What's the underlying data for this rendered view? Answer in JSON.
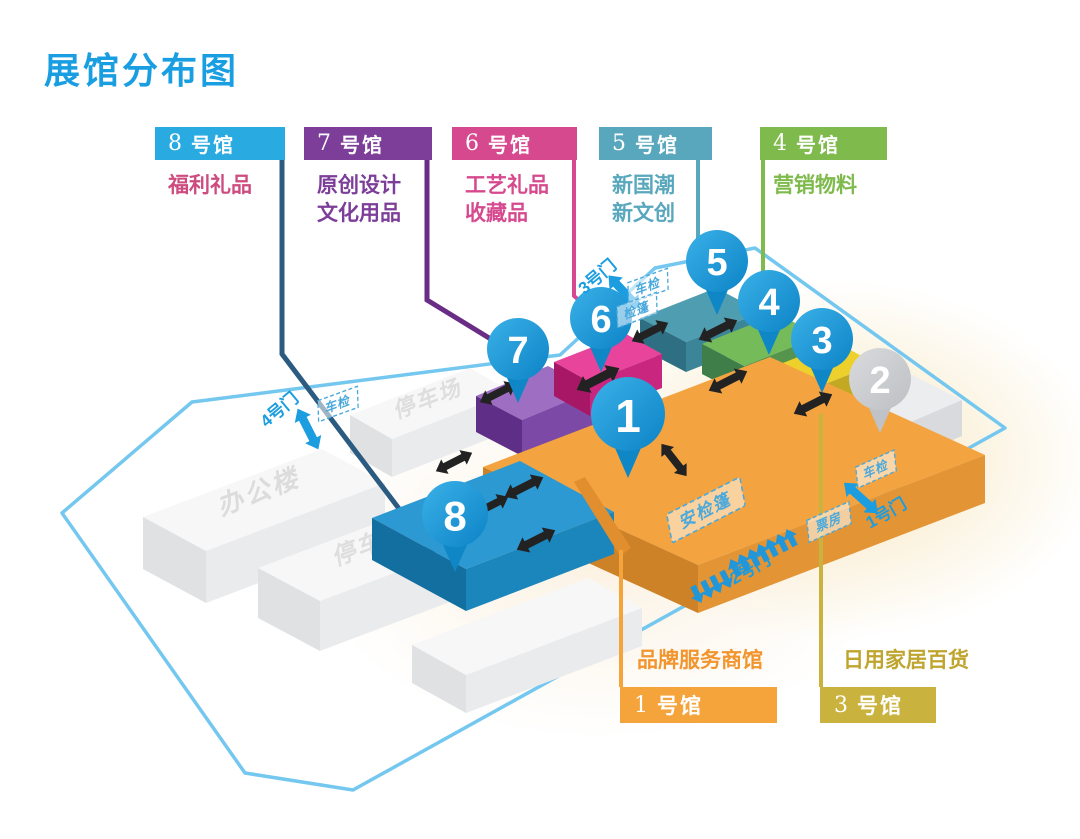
{
  "title": "展馆分布图",
  "top_halls": [
    {
      "num": "8",
      "suffix": "号馆",
      "desc_lines": [
        "福利礼品"
      ],
      "header_bg": "#29ABE2",
      "desc_color": "#CE4B80"
    },
    {
      "num": "7",
      "suffix": "号馆",
      "desc_lines": [
        "原创设计",
        "文化用品"
      ],
      "header_bg": "#7C3E98",
      "desc_color": "#7C3E98"
    },
    {
      "num": "6",
      "suffix": "号馆",
      "desc_lines": [
        "工艺礼品",
        "收藏品"
      ],
      "header_bg": "#D6498F",
      "desc_color": "#D6498F"
    },
    {
      "num": "5",
      "suffix": "号馆",
      "desc_lines": [
        "新国潮",
        "新文创"
      ],
      "header_bg": "#58A7BC",
      "desc_color": "#58A7BC"
    },
    {
      "num": "4",
      "suffix": "号馆",
      "desc_lines": [
        "营销物料"
      ],
      "header_bg": "#7FBA4C",
      "desc_color": "#7FBA4C"
    }
  ],
  "bottom_halls": [
    {
      "num": "1",
      "suffix": "号馆",
      "desc": "品牌服务商馆",
      "header_bg": "#F5A33B",
      "desc_color": "#F2952E"
    },
    {
      "num": "3",
      "suffix": "号馆",
      "desc": "日用家居百货",
      "header_bg": "#C9B23D",
      "desc_color": "#BFA52E"
    }
  ],
  "pins": [
    {
      "n": "1"
    },
    {
      "n": "2"
    },
    {
      "n": "3"
    },
    {
      "n": "4"
    },
    {
      "n": "5"
    },
    {
      "n": "6"
    },
    {
      "n": "7"
    },
    {
      "n": "8"
    }
  ],
  "buildings": {
    "office": "办公楼",
    "parking_top": "停车场",
    "parking_mid": "停车场"
  },
  "gates": {
    "g1": "1号门",
    "g2": "2号门",
    "g3": "3号门",
    "g4": "4号门"
  },
  "checkpoints": {
    "vehicle": "车检",
    "tent": "检篷",
    "ticket": "票房",
    "security_tent": "安检篷"
  },
  "colors": {
    "title": "#1A9EE2",
    "boundary": "#74C7EF",
    "gate_blue": "#1B9DE0",
    "dashed_label": "#4AA9DC",
    "black_arrow": "#222222",
    "pin_blue": "#1592D2",
    "pin_gray": "#C9CBCE",
    "hall1_block": "#F3A440",
    "hall8_block": "#2C99D2",
    "hall7_block": "#9E6EC2",
    "hall6_block": "#E8449B",
    "hall5_block": "#4E9DB1",
    "hall4_block": "#76BB59",
    "hall3_block": "#EDD02B",
    "hall2_block": "#ECEDEF"
  }
}
